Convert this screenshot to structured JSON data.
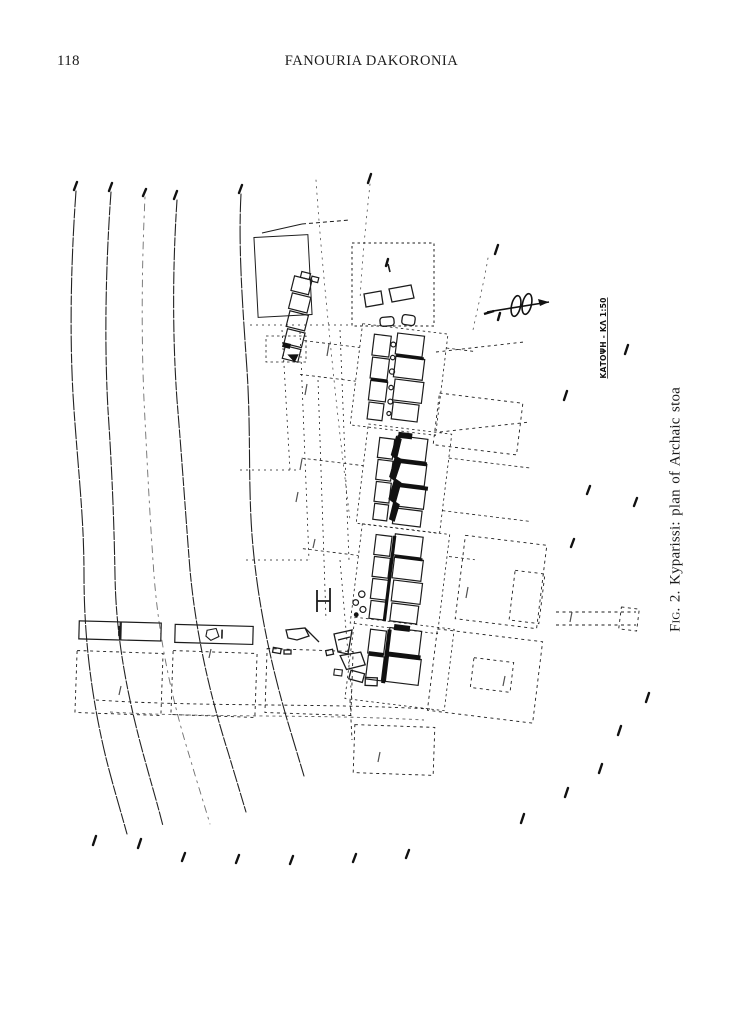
{
  "page": {
    "number": "118",
    "running_head": "FANOURIA DAKORONIA"
  },
  "figure": {
    "caption_fig_label": "Fig. 2.",
    "caption_text": "Kyparissi: plan of Archaic stoa",
    "plan_label": "ΚΑΤΟΨΗ - ΚΛ 1:50"
  },
  "colors": {
    "ink": "#1a1a1a",
    "paper": "#ffffff"
  }
}
